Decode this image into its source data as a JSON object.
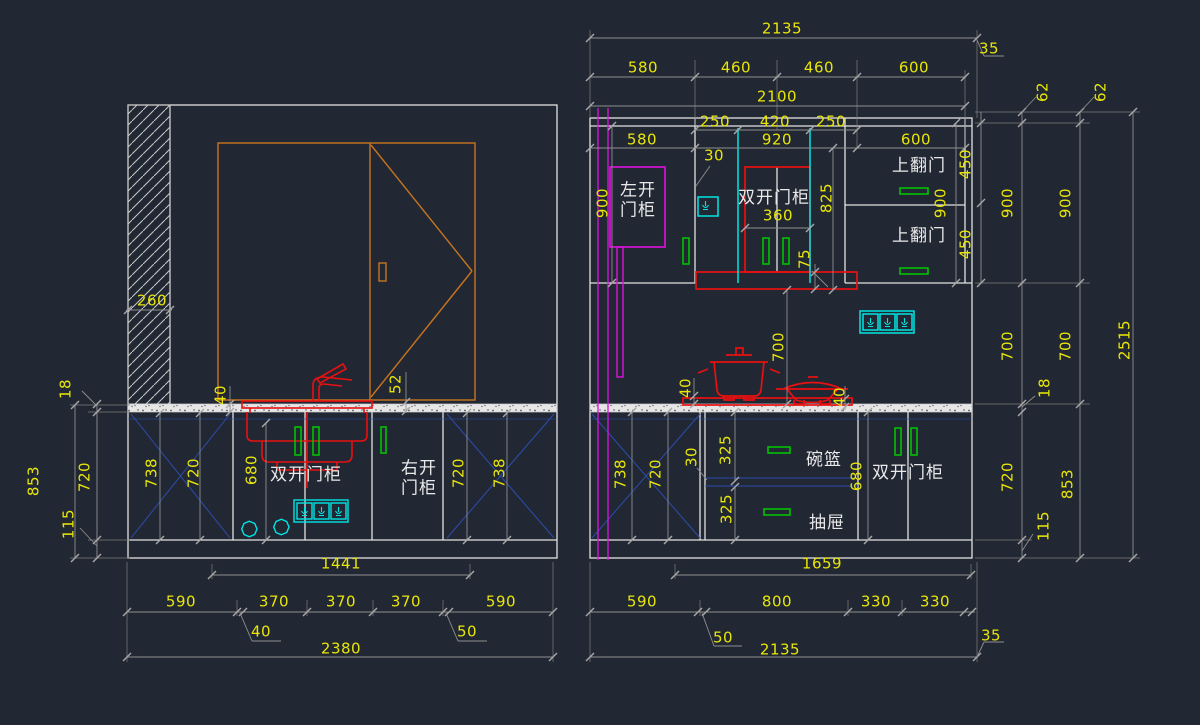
{
  "drawing": {
    "type": "kitchen cabinet elevation drawings",
    "views": [
      "left-elevation",
      "right-elevation"
    ]
  },
  "colors": {
    "background": "#222833",
    "structure_white": "#e2e2e2",
    "dim_gray": "#8f8f8f",
    "dim_text_yellow": "#e8e50a",
    "label_white": "#e9e9e9",
    "fixture_red": "#e81010",
    "handle_green": "#00cc00",
    "electric_cyan": "#00e5e5",
    "panel_magenta": "#e010e0",
    "window_orange": "#c8741f",
    "cross_blue": "#2c4cae"
  },
  "left_elevation": {
    "annotations": [
      {
        "name": "dim-hatch-width",
        "text": "260",
        "x": 152,
        "y": 301
      },
      {
        "name": "dim-counter-thickness",
        "text": "18",
        "x": 66,
        "y": 389,
        "rot": 1
      },
      {
        "name": "dim-base-total-height",
        "text": "853",
        "x": 34,
        "y": 481,
        "rot": 1
      },
      {
        "name": "dim-base-cabinet-height",
        "text": "720",
        "x": 85,
        "y": 477,
        "rot": 1
      },
      {
        "name": "dim-plinth-height",
        "text": "115",
        "x": 69,
        "y": 524,
        "rot": 1
      },
      {
        "name": "dim-counter-overhang",
        "text": "40",
        "x": 221,
        "y": 395,
        "rot": 1
      },
      {
        "name": "dim-window-gap",
        "text": "52",
        "x": 396,
        "y": 384,
        "rot": 1
      },
      {
        "name": "dim-panel-738-left",
        "text": "738",
        "x": 152,
        "y": 473,
        "rot": 1
      },
      {
        "name": "dim-panel-720-left",
        "text": "720",
        "x": 194,
        "y": 473,
        "rot": 1
      },
      {
        "name": "dim-interior-680",
        "text": "680",
        "x": 252,
        "y": 470,
        "rot": 1
      },
      {
        "name": "label-double-door-cabinet",
        "text": "双开门柜",
        "x": 306,
        "y": 476,
        "cn": 1
      },
      {
        "name": "label-right-door-cabinet",
        "text": "右开\n门柜",
        "x": 419,
        "y": 479,
        "cn": 1
      },
      {
        "name": "dim-panel-720-right",
        "text": "720",
        "x": 459,
        "y": 473,
        "rot": 1
      },
      {
        "name": "dim-panel-738-right",
        "text": "738",
        "x": 500,
        "y": 473,
        "rot": 1
      },
      {
        "name": "dim-1441",
        "text": "1441",
        "x": 341,
        "y": 564
      },
      {
        "name": "dim-590-left",
        "text": "590",
        "x": 181,
        "y": 602
      },
      {
        "name": "dim-370-a",
        "text": "370",
        "x": 274,
        "y": 602
      },
      {
        "name": "dim-370-b",
        "text": "370",
        "x": 341,
        "y": 602
      },
      {
        "name": "dim-370-c",
        "text": "370",
        "x": 406,
        "y": 602
      },
      {
        "name": "dim-590-right",
        "text": "590",
        "x": 501,
        "y": 602
      },
      {
        "name": "dim-40-offset",
        "text": "40",
        "x": 261,
        "y": 632
      },
      {
        "name": "dim-50-offset",
        "text": "50",
        "x": 467,
        "y": 632
      },
      {
        "name": "dim-2380-overall",
        "text": "2380",
        "x": 341,
        "y": 649
      }
    ]
  },
  "right_elevation": {
    "annotations": [
      {
        "name": "dim-2135-top",
        "text": "2135",
        "x": 782,
        "y": 29
      },
      {
        "name": "dim-35-top",
        "text": "35",
        "x": 989,
        "y": 49
      },
      {
        "name": "dim-580-top",
        "text": "580",
        "x": 643,
        "y": 68
      },
      {
        "name": "dim-460-a",
        "text": "460",
        "x": 736,
        "y": 68
      },
      {
        "name": "dim-460-b",
        "text": "460",
        "x": 819,
        "y": 68
      },
      {
        "name": "dim-600-top",
        "text": "600",
        "x": 914,
        "y": 68
      },
      {
        "name": "dim-2100",
        "text": "2100",
        "x": 777,
        "y": 97
      },
      {
        "name": "dim-250-a",
        "text": "250",
        "x": 715,
        "y": 122
      },
      {
        "name": "dim-420",
        "text": "420",
        "x": 775,
        "y": 122
      },
      {
        "name": "dim-250-b",
        "text": "250",
        "x": 831,
        "y": 122
      },
      {
        "name": "dim-580-inner",
        "text": "580",
        "x": 642,
        "y": 140
      },
      {
        "name": "dim-920",
        "text": "920",
        "x": 777,
        "y": 140
      },
      {
        "name": "dim-600-inner",
        "text": "600",
        "x": 916,
        "y": 140
      },
      {
        "name": "dim-30-upper",
        "text": "30",
        "x": 714,
        "y": 156
      },
      {
        "name": "label-left-door-cabinet",
        "text": "左开\n门柜",
        "x": 638,
        "y": 201,
        "cn": 1
      },
      {
        "name": "label-double-door-cabinet-upper",
        "text": "双开门柜",
        "x": 774,
        "y": 199,
        "cn": 1
      },
      {
        "name": "dim-360",
        "text": "360",
        "x": 778,
        "y": 216
      },
      {
        "name": "dim-825",
        "text": "825",
        "x": 827,
        "y": 198,
        "rot": 1
      },
      {
        "name": "dim-900-left",
        "text": "900",
        "x": 603,
        "y": 203,
        "rot": 1
      },
      {
        "name": "dim-75-hood",
        "text": "75",
        "x": 805,
        "y": 259,
        "rot": 1
      },
      {
        "name": "label-flip-up-door-top",
        "text": "上翻门",
        "x": 919,
        "y": 167,
        "cn": 1
      },
      {
        "name": "label-flip-up-door-bottom",
        "text": "上翻门",
        "x": 919,
        "y": 237,
        "cn": 1
      },
      {
        "name": "dim-450-a",
        "text": "450",
        "x": 966,
        "y": 164,
        "rot": 1
      },
      {
        "name": "dim-450-b",
        "text": "450",
        "x": 966,
        "y": 244,
        "rot": 1
      },
      {
        "name": "dim-900-inner",
        "text": "900",
        "x": 941,
        "y": 203,
        "rot": 1
      },
      {
        "name": "dim-62-a",
        "text": "62",
        "x": 1043,
        "y": 92,
        "rot": 1
      },
      {
        "name": "dim-62-b",
        "text": "62",
        "x": 1101,
        "y": 92,
        "rot": 1
      },
      {
        "name": "dim-900-col1",
        "text": "900",
        "x": 1008,
        "y": 203,
        "rot": 1
      },
      {
        "name": "dim-900-col2",
        "text": "900",
        "x": 1066,
        "y": 203,
        "rot": 1
      },
      {
        "name": "dim-700-interior",
        "text": "700",
        "x": 779,
        "y": 347,
        "rot": 1
      },
      {
        "name": "dim-700-col1",
        "text": "700",
        "x": 1008,
        "y": 346,
        "rot": 1
      },
      {
        "name": "dim-700-col2",
        "text": "700",
        "x": 1066,
        "y": 346,
        "rot": 1
      },
      {
        "name": "dim-2515-overall",
        "text": "2515",
        "x": 1125,
        "y": 340,
        "rot": 1
      },
      {
        "name": "dim-40-cooktop-left",
        "text": "40",
        "x": 686,
        "y": 388,
        "rot": 1
      },
      {
        "name": "dim-40-cooktop-right",
        "text": "40",
        "x": 840,
        "y": 397,
        "rot": 1
      },
      {
        "name": "dim-18-counter",
        "text": "18",
        "x": 1045,
        "y": 388,
        "rot": 1
      },
      {
        "name": "dim-720-base",
        "text": "720",
        "x": 1008,
        "y": 477,
        "rot": 1
      },
      {
        "name": "dim-115-plinth",
        "text": "115",
        "x": 1044,
        "y": 526,
        "rot": 1
      },
      {
        "name": "dim-853-base-total",
        "text": "853",
        "x": 1068,
        "y": 484,
        "rot": 1
      },
      {
        "name": "dim-738-base",
        "text": "738",
        "x": 621,
        "y": 474,
        "rot": 1
      },
      {
        "name": "dim-720-base-panel",
        "text": "720",
        "x": 656,
        "y": 474,
        "rot": 1
      },
      {
        "name": "dim-30-base",
        "text": "30",
        "x": 692,
        "y": 457,
        "rot": 1
      },
      {
        "name": "dim-325-a",
        "text": "325",
        "x": 726,
        "y": 450,
        "rot": 1
      },
      {
        "name": "dim-325-b",
        "text": "325",
        "x": 727,
        "y": 509,
        "rot": 1
      },
      {
        "name": "label-bowl-basket",
        "text": "碗篮",
        "x": 824,
        "y": 461,
        "cn": 1
      },
      {
        "name": "dim-680-base",
        "text": "680",
        "x": 857,
        "y": 476,
        "rot": 1
      },
      {
        "name": "label-double-door-cabinet-base",
        "text": "双开门柜",
        "x": 908,
        "y": 474,
        "cn": 1
      },
      {
        "name": "label-drawer",
        "text": "抽屉",
        "x": 827,
        "y": 524,
        "cn": 1
      },
      {
        "name": "dim-1659",
        "text": "1659",
        "x": 822,
        "y": 564
      },
      {
        "name": "dim-590-bottom",
        "text": "590",
        "x": 642,
        "y": 602
      },
      {
        "name": "dim-800",
        "text": "800",
        "x": 777,
        "y": 602
      },
      {
        "name": "dim-330-a",
        "text": "330",
        "x": 876,
        "y": 602
      },
      {
        "name": "dim-330-b",
        "text": "330",
        "x": 935,
        "y": 602
      },
      {
        "name": "dim-50-offset-right",
        "text": "50",
        "x": 723,
        "y": 638
      },
      {
        "name": "dim-2135-bottom",
        "text": "2135",
        "x": 780,
        "y": 650
      },
      {
        "name": "dim-35-bottom",
        "text": "35",
        "x": 991,
        "y": 636
      }
    ]
  }
}
